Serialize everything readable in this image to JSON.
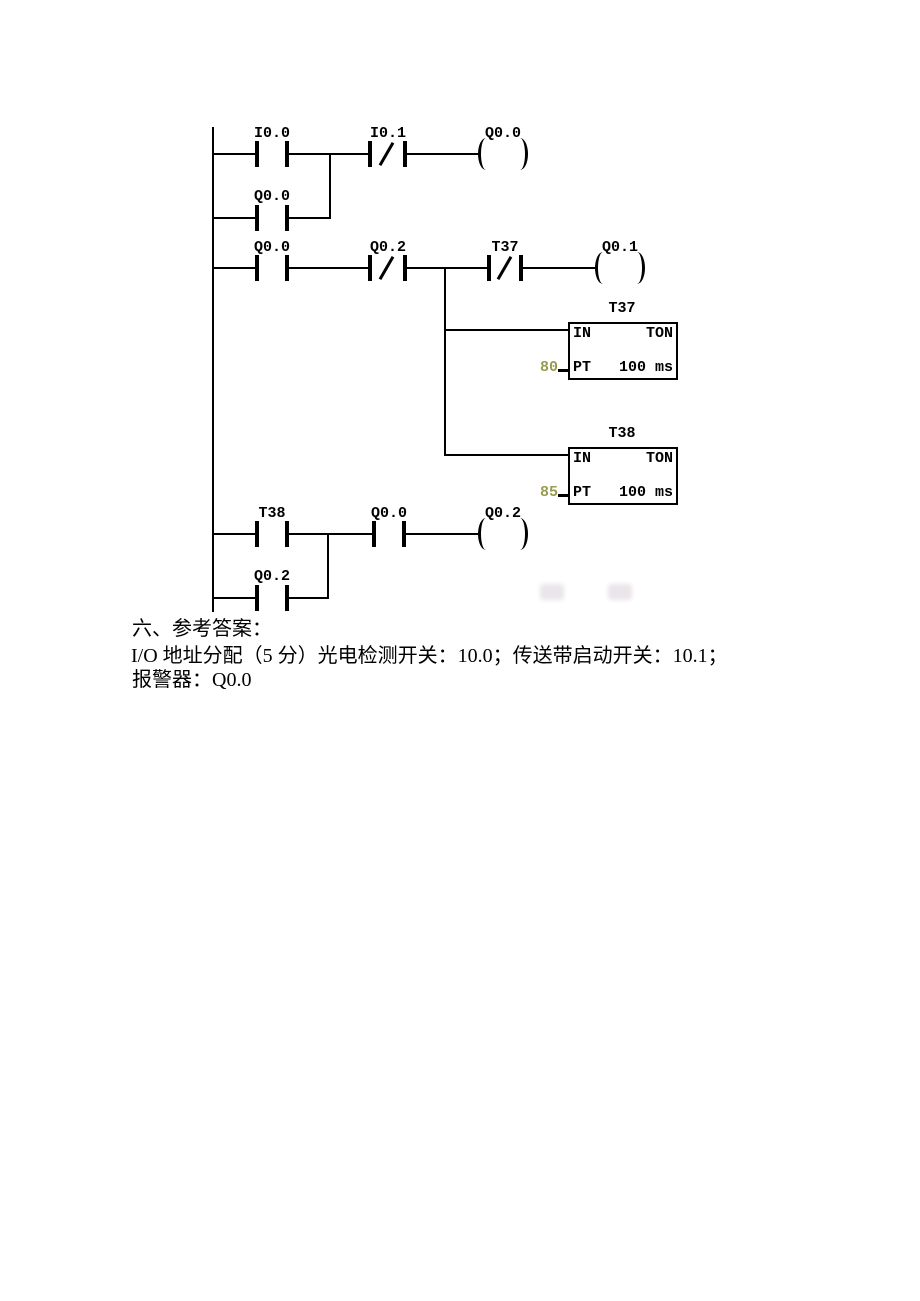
{
  "colors": {
    "line": "#000000",
    "preset_value": "#9b9b4f",
    "background": "#ffffff"
  },
  "ladder": {
    "rung1": {
      "contact_io0": "I0.0",
      "contact_io1": "I0.1",
      "coil": "Q0.0",
      "parallel_contact": "Q0.0"
    },
    "rung2": {
      "contact_q00": "Q0.0",
      "contact_q02": "Q0.2",
      "contact_t37": "T37",
      "coil": "Q0.1"
    },
    "timer_t37": {
      "name": "T37",
      "in_label": "IN",
      "type_label": "TON",
      "pt_label": "PT",
      "preset": "80",
      "time_base": "100 ms"
    },
    "timer_t38": {
      "name": "T38",
      "in_label": "IN",
      "type_label": "TON",
      "pt_label": "PT",
      "preset": "85",
      "time_base": "100 ms"
    },
    "rung3": {
      "contact_t38": "T38",
      "contact_q00": "Q0.0",
      "coil": "Q0.2",
      "parallel_contact": "Q0.2"
    }
  },
  "answer": {
    "heading": "六、参考答案：",
    "io_line": "I/O 地址分配（5 分）光电检测开关：10.0；传送带启动开关：10.1；",
    "alarm_line": "报警器：Q0.0"
  }
}
